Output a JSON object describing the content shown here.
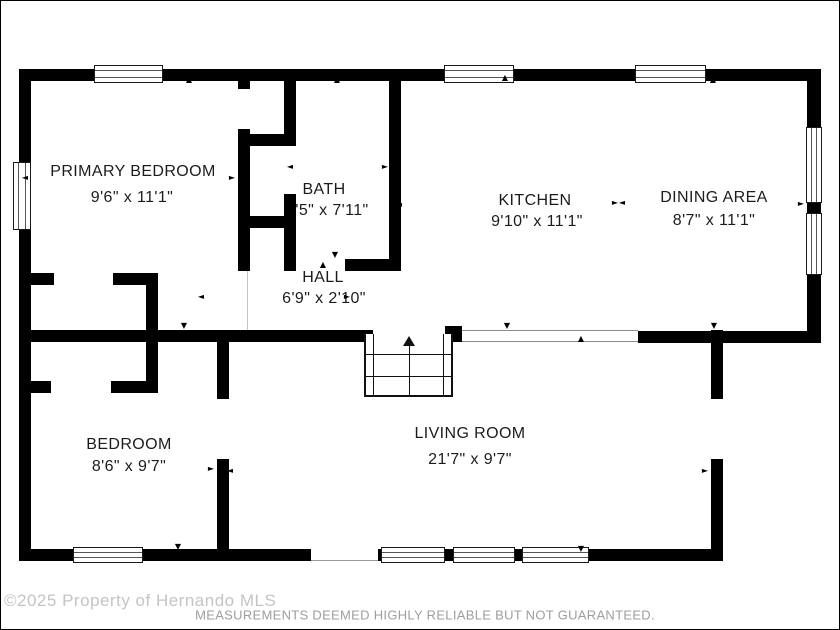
{
  "rooms": {
    "primary_bedroom": {
      "name": "PRIMARY BEDROOM",
      "dims": "9'6\" x 11'1\""
    },
    "bath": {
      "name": "BATH",
      "dims": "'5\" x 7'11\""
    },
    "kitchen": {
      "name": "KITCHEN",
      "dims": "9'10\" x 11'1\""
    },
    "dining": {
      "name": "DINING AREA",
      "dims": "8'7\" x 11'1\""
    },
    "hall": {
      "name": "HALL",
      "dims": "6'9\" x 2'10\""
    },
    "bedroom": {
      "name": "BEDROOM",
      "dims": "8'6\" x 9'7\""
    },
    "living": {
      "name": "LIVING ROOM",
      "dims": "21'7\" x 9'7\""
    }
  },
  "icons": {
    "arrow_up": "▲",
    "arrow_down": "▼",
    "arrow_left": "◄",
    "arrow_right": "►"
  },
  "footer": {
    "watermark": "©2025 Property of Hernando MLS",
    "disclaimer": "MEASUREMENTS DEEMED HIGHLY RELIABLE BUT NOT GUARANTEED."
  },
  "colors": {
    "wall": "#000000",
    "label": "#1c1c1c",
    "watermark": "#c4c4c4",
    "disclaimer": "#9e9e9e"
  }
}
